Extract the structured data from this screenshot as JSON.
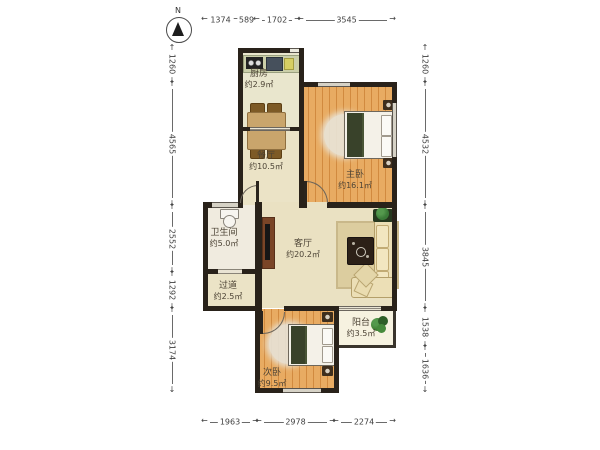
{
  "compass": {
    "label": "N"
  },
  "rooms": {
    "kitchen": {
      "name": "厨房",
      "area": "约2.9㎡"
    },
    "dining": {
      "name": "餐厅",
      "area": "约10.5㎡"
    },
    "master_bedroom": {
      "name": "主卧",
      "area": "约16.1㎡"
    },
    "bathroom": {
      "name": "卫生间",
      "area": "约5.0㎡"
    },
    "living": {
      "name": "客厅",
      "area": "约20.2㎡"
    },
    "hallway": {
      "name": "过道",
      "area": "约2.5㎡"
    },
    "second_bedroom": {
      "name": "次卧",
      "area": "约9.5㎡"
    },
    "balcony": {
      "name": "阳台",
      "area": "约3.5㎡"
    }
  },
  "dims": {
    "top": [
      "1374",
      "589",
      "1702",
      "3545"
    ],
    "bottom": [
      "1963",
      "2978",
      "2274"
    ],
    "left": [
      "1260",
      "4565",
      "2552",
      "1292",
      "3174"
    ],
    "right": [
      "1260",
      "4532",
      "3845",
      "1538",
      "1636"
    ]
  },
  "colors": {
    "wall": "#29221a",
    "wood_floor": "#e8ab62",
    "cream_floor": "#ebe3c6",
    "bathroom_floor": "#f0ebdf",
    "balcony_floor": "#f6f2e0",
    "dimension_text": "#3f3f3f",
    "label_text": "#4c4335",
    "plant_green": "#3f7d33"
  }
}
